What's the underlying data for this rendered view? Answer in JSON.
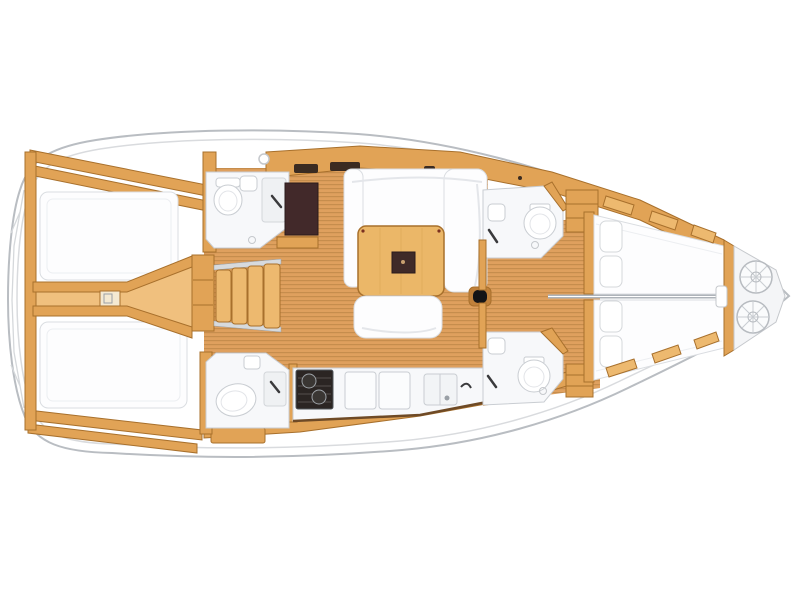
{
  "document": {
    "kind": "yacht-interior-floorplan",
    "orientation": "bow-right"
  },
  "colors": {
    "wood": "#E1A356",
    "wood-light": "#F0C07E",
    "wood-stroke": "#A8702C",
    "wood-deep": "#C0813B",
    "floor-base": "#DFA05E",
    "floor-stripe": "#C68D4D",
    "room": "#F7F8FA",
    "fixture": "#C9CDD2",
    "berth": "#FDFDFE",
    "berth-stroke": "#DADDE1",
    "hull-stroke": "#B9BDC2",
    "deck-line": "#D9DBDE",
    "chrome": "#D7DADD",
    "dark-brown": "#42292A",
    "stove": "#2B2523",
    "black": "#141416",
    "divider": "#AEB3B9",
    "slot": "#3B2B21",
    "locker": "#EDB96F",
    "bg": "#FFFFFF"
  },
  "regions": {
    "hull": "sailboat hull outline",
    "aft_cabin_port": "aft double cabin port",
    "aft_cabin_starboard": "aft double cabin starboard",
    "stern_corridor": "stern centerline corridor",
    "companionway": "companionway stairs",
    "aft_head_port": "aft head with toilet and shower",
    "aft_head_starboard": "aft head with toilet and shower",
    "nav_station": "chart table nav station",
    "salon": "salon with U-settee and table",
    "galley": "galley with stove sinks and fridge",
    "mast": "mast step",
    "fwd_head_port": "forward head port",
    "fwd_head_starboard": "forward head starboard",
    "fwd_cabin_port": "forward cabin port berth",
    "fwd_cabin_starboard": "forward cabin starboard berth",
    "anchor_locker": "bow anchor locker with rope coils"
  }
}
